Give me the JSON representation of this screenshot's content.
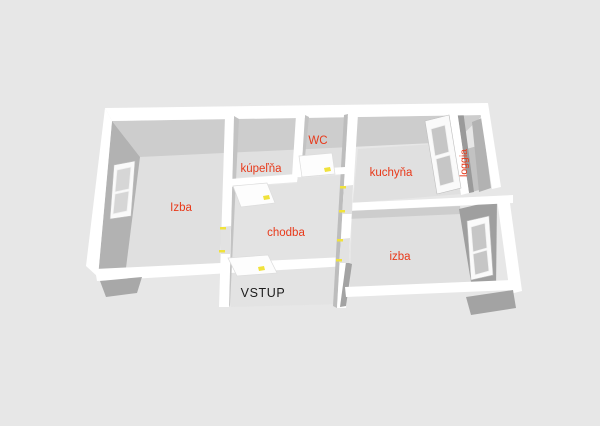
{
  "scene": {
    "title": "3D floor plan",
    "background": "#e7e7e7"
  },
  "rooms": [
    {
      "id": "izba-left",
      "label": "Izba"
    },
    {
      "id": "kupelna",
      "label": "kúpeľňa"
    },
    {
      "id": "wc",
      "label": "WC"
    },
    {
      "id": "kuchyna",
      "label": "kuchyňa"
    },
    {
      "id": "chodba",
      "label": "chodba"
    },
    {
      "id": "izba-right",
      "label": "izba"
    },
    {
      "id": "loggia",
      "label": "loggia"
    }
  ],
  "entrance": {
    "label": "VSTUP"
  },
  "colors": {
    "background": "#e7e7e7",
    "floor": "#e0e0e0",
    "floor_loggia": "#c2c2c2",
    "wall_top": "#ffffff",
    "wall_face_light": "#cdcdcd",
    "wall_face_mid": "#b2b2b2",
    "wall_face_dark": "#9f9f9f",
    "room_label": "#e8391a",
    "entrance_label": "#1c1c1c",
    "door_marker": "#f0e23c"
  }
}
